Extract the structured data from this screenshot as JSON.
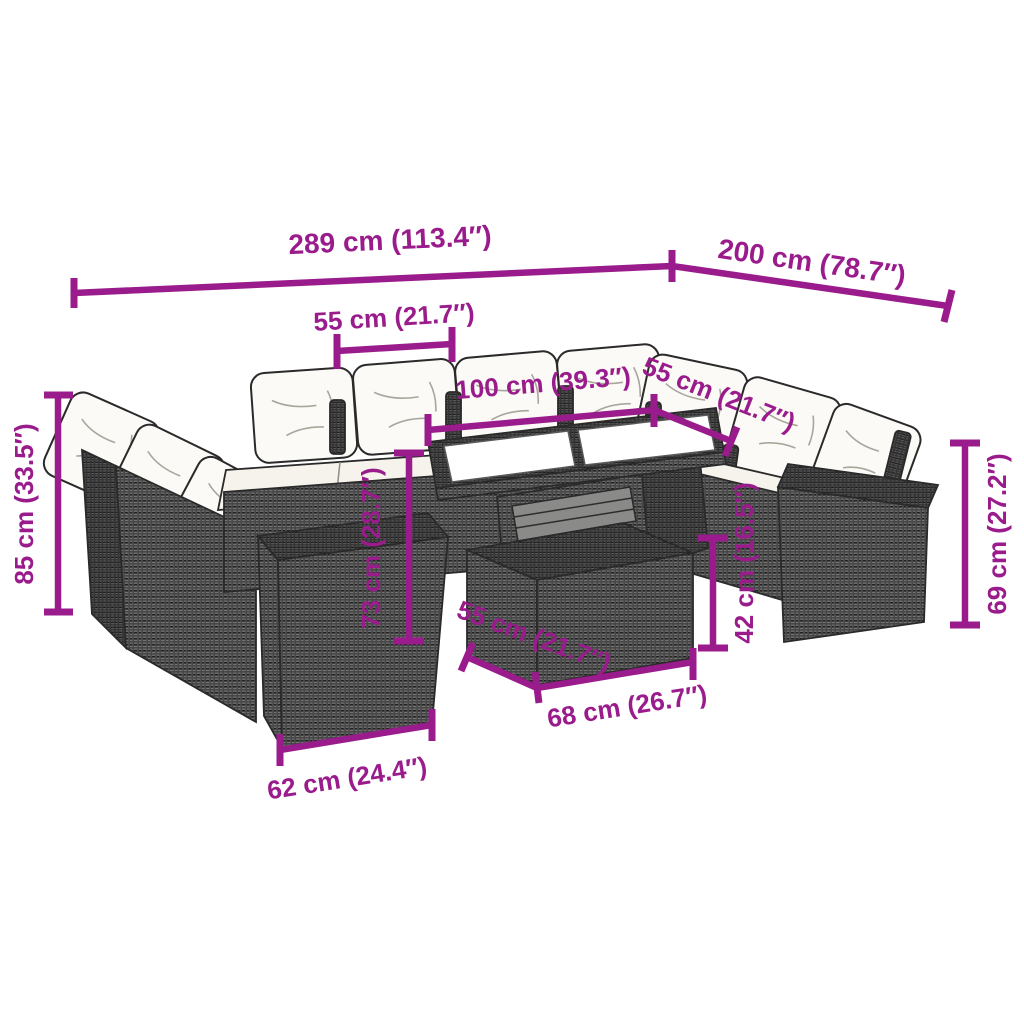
{
  "style": {
    "dimension_color": "#9A1C8C",
    "line_color": "#2a2a2a",
    "background": "#ffffff",
    "cushion_color": "#fbfaf6"
  },
  "illustration": {
    "subject": "rattan garden lounge sofa set with cushions, glass-top table, ottoman and side tables",
    "view": "three-quarter perspective line drawing"
  },
  "dims": [
    {
      "id": "overall-width",
      "label": "289 cm (113.4″)"
    },
    {
      "id": "overall-depth",
      "label": "200 cm (78.7″)"
    },
    {
      "id": "seat-width-back",
      "label": "55 cm (21.7″)"
    },
    {
      "id": "table-length",
      "label": "100 cm (39.3″)"
    },
    {
      "id": "seat-width-right",
      "label": "55 cm (21.7″)"
    },
    {
      "id": "sofa-height",
      "label": "85 cm (33.5″)"
    },
    {
      "id": "table-height",
      "label": "73 cm (28.7″)"
    },
    {
      "id": "ottoman-height",
      "label": "42 cm (16.5″)"
    },
    {
      "id": "side-table-height",
      "label": "69 cm (27.2″)"
    },
    {
      "id": "ottoman-width",
      "label": "55 cm (21.7″)"
    },
    {
      "id": "ottoman-depth",
      "label": "68 cm (26.7″)"
    },
    {
      "id": "side-table-width",
      "label": "62 cm (24.4″)"
    }
  ]
}
